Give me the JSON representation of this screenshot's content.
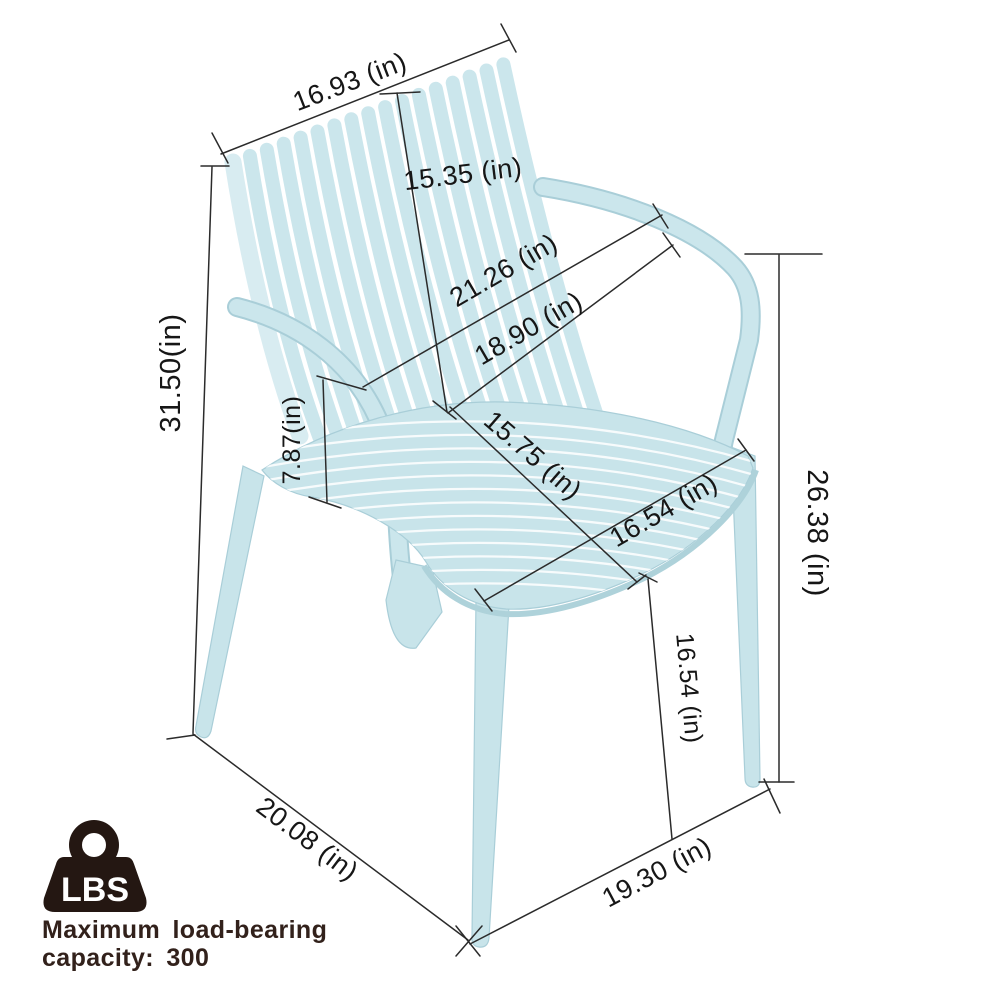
{
  "chair": {
    "color": "#c8e4ea",
    "edge_color": "#a9ced8",
    "line_color": "#2b2b2b"
  },
  "dims": {
    "back_width": "16.93 (in)",
    "back_height": "15.35 (in)",
    "overall_width": "21.26 (in)",
    "inner_width": "18.90 (in)",
    "overall_height": "31.50(in)",
    "arm_to_seat_height": "7.87(in)",
    "seat_depth": "15.75 (in)",
    "seat_width": "16.54 (in)",
    "arm_height": "26.38 (in)",
    "seat_height": "16.54 (in)",
    "base_depth": "20.08 (in)",
    "base_width": "19.30 (in)"
  },
  "load_badge": {
    "icon_text": "LBS",
    "line1": "Maximum load-bearing",
    "line2": "capacity: 300",
    "icon_color": "#241712",
    "text_color": "#32211b"
  }
}
